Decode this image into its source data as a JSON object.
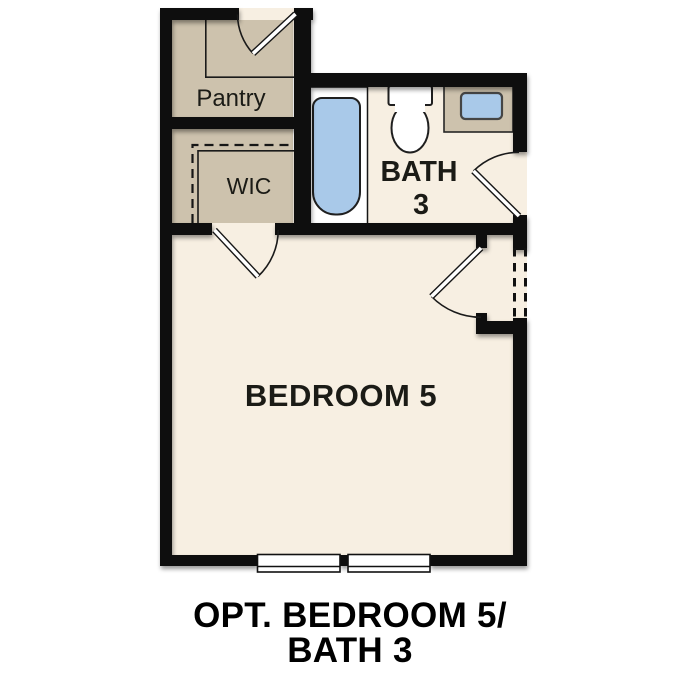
{
  "plan": {
    "rooms": {
      "pantry": {
        "label": "Pantry"
      },
      "wic": {
        "label": "WIC"
      },
      "bath": {
        "label_line1": "BATH",
        "label_line2": "3"
      },
      "bedroom": {
        "label": "BEDROOM 5"
      }
    },
    "fixtures": [
      "bathtub",
      "toilet",
      "vanity-sink"
    ],
    "caption": {
      "line1": "OPT. BEDROOM 5/",
      "line2": "BATH 3"
    }
  },
  "colors": {
    "wall": "#0e0e0e",
    "floor_cream": "#f7efe2",
    "optional_tan": "#cdc2ad",
    "fixture_blue": "#a9c9e9",
    "background": "#ffffff"
  }
}
